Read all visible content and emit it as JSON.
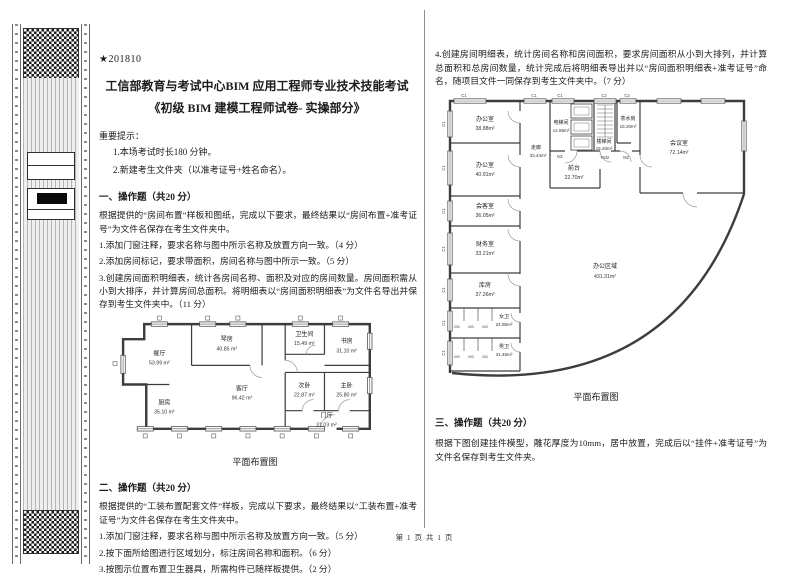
{
  "meta": {
    "exam_code": "★201810",
    "footer": "第 1 页 共 1 页"
  },
  "header": {
    "title_line1": "工信部教育与考试中心BIM 应用工程师专业技术技能考试",
    "title_line2": "《初级 BIM 建模工程师试卷- 实操部分》",
    "notice_heading": "重要提示：",
    "notice_1": "1.本场考试时长180 分钟。",
    "notice_2": "2.新建考生文件夹（以准考证号+姓名命名）。"
  },
  "section1": {
    "heading": "一、操作题（共20 分）",
    "intro": "根据提供的“房间布置”样板和图纸，完成以下要求，最终结果以“房间布置+准考证号”为文件名保存在考生文件夹中。",
    "items": [
      "1.添加门窗注释，要求名称与图中所示名称及放置方向一致。（4 分）",
      "2.添加房间标记，要求带面积，房间名称与图中所示一致。（5 分）",
      "3.创建房间面积明细表，统计各房间名称、面积及对应的房间数量。房间面积需从小到大排序，并计算房间总面积。将明细表以“房间面积明细表”为文件名导出并保存到考生文件夹中。（11 分）"
    ]
  },
  "plan1": {
    "caption": "平面布置图",
    "rooms": [
      {
        "name": "餐厅",
        "area": "53.99 m²"
      },
      {
        "name": "琴房",
        "area": "40.85 m²"
      },
      {
        "name": "卫生间",
        "area": "15.49 m²"
      },
      {
        "name": "书房",
        "area": "31.10 m²"
      },
      {
        "name": "次卧",
        "area": "22.87 m²"
      },
      {
        "name": "主卧",
        "area": "25.80 m²"
      },
      {
        "name": "厨房",
        "area": "35.10 m²"
      },
      {
        "name": "客厅",
        "area": "96.42 m²"
      },
      {
        "name": "门厅",
        "area": "31.03 m²"
      }
    ]
  },
  "section2": {
    "heading": "二、操作题（共20 分）",
    "intro": "根据提供的“工装布置配套文件”样板，完成以下要求，最终结果以“工装布置+准考证号”为文件名保存在考生文件夹中。",
    "items": [
      "1.添加门窗注释，要求名称与图中所示名称及放置方向一致。（5 分）",
      "2.按下面所给图进行区域划分，标注房间名称和面积。（6 分）",
      "3.按图示位置布置卫生器具，所需构件已随样板提供。（2 分）"
    ],
    "item4": "4.创建房间明细表，统计房间名称和房间面积，要求房间面积从小到大排列，并计算总面积和总房间数量，统计完成后将明细表导出并以“房间面积明细表+准考证号”命名，随项目文件一同保存到考生文件夹中。（7 分）"
  },
  "plan2": {
    "caption": "平面布置图",
    "rooms": [
      {
        "name": "办公室",
        "area": "38.88m²"
      },
      {
        "name": "办公室",
        "area": "40.91m²"
      },
      {
        "name": "会客室",
        "area": "36.05m²"
      },
      {
        "name": "财务室",
        "area": "33.21m²"
      },
      {
        "name": "库房",
        "area": "37.26m²"
      },
      {
        "name": "女卫",
        "area": "24.95m²"
      },
      {
        "name": "男卫",
        "area": "31.45m²"
      },
      {
        "name": "走廊",
        "area": "33.44m²"
      },
      {
        "name": "电梯间",
        "area": "14.85m²"
      },
      {
        "name": "前台",
        "area": "22.70m²"
      },
      {
        "name": "楼梯间",
        "area": "15.20m²"
      },
      {
        "name": "茶水房",
        "area": "15.20m²"
      },
      {
        "name": "会议室",
        "area": "72.14m²"
      },
      {
        "name": "办公区域",
        "area": "431.31m²"
      }
    ],
    "marks": {
      "c1": "C1",
      "c2": "C2",
      "m1": "M1",
      "m2": "M2",
      "m3": "M3",
      "fm2": "FM2"
    }
  },
  "section3": {
    "heading": "三、操作题（共20 分）",
    "intro": "根据下图创建挂件模型，雕花厚度为10mm，居中放置，完成后以“挂件+准考证号”为文件名保存到考生文件夹。"
  }
}
